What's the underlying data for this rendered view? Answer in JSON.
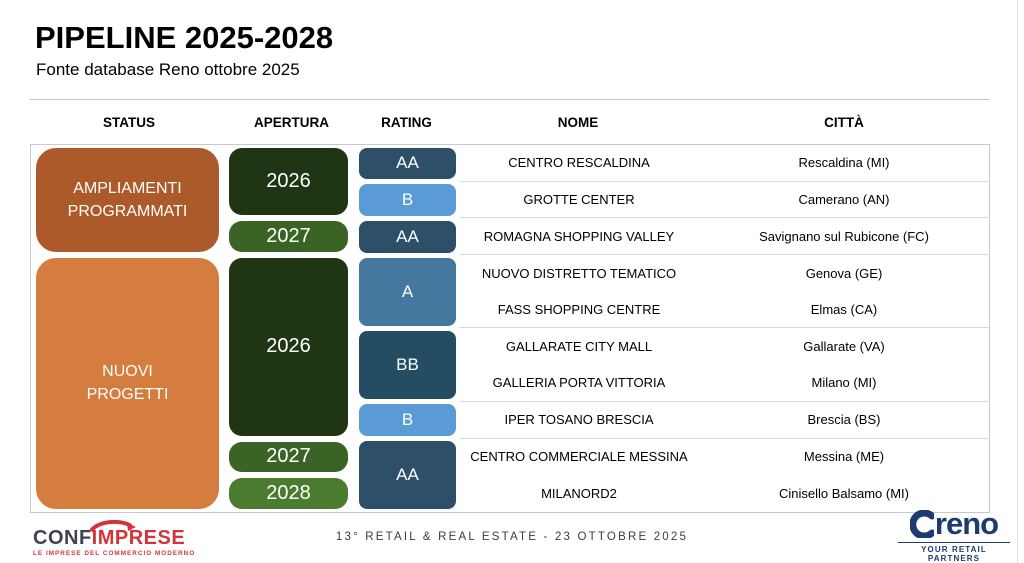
{
  "slide": {
    "title": "PIPELINE 2025-2028",
    "subtitle": "Fonte database Reno ottobre 2025"
  },
  "table": {
    "headers": [
      "STATUS",
      "APERTURA",
      "RATING",
      "NOME",
      "CITTÀ"
    ],
    "status_groups": [
      {
        "label": "AMPLIAMENTI\nPROGRAMMATI",
        "rows": 3,
        "color": "#ad5a2b"
      },
      {
        "label": "NUOVI\nPROGETTI",
        "rows": 7,
        "color": "#d47d3e"
      }
    ],
    "apertura_blocks": [
      {
        "label": "2026",
        "rows": 2,
        "color": "#1f3513"
      },
      {
        "label": "2027",
        "rows": 1,
        "color": "#3a6325"
      },
      {
        "label": "2026",
        "rows": 5,
        "color": "#1f3513"
      },
      {
        "label": "2027",
        "rows": 1,
        "color": "#3a6325"
      },
      {
        "label": "2028",
        "rows": 1,
        "color": "#4a7b2e"
      }
    ],
    "rating_blocks": [
      {
        "label": "AA",
        "rows": 1,
        "color": "#2d5068"
      },
      {
        "label": "B",
        "rows": 1,
        "color": "#5b9bd5"
      },
      {
        "label": "AA",
        "rows": 1,
        "color": "#2d5068"
      },
      {
        "label": "A",
        "rows": 2,
        "color": "#44789f"
      },
      {
        "label": "BB",
        "rows": 2,
        "color": "#244d64"
      },
      {
        "label": "B",
        "rows": 1,
        "color": "#5b9bd5"
      },
      {
        "label": "AA",
        "rows": 2,
        "color": "#2d5068"
      }
    ],
    "rows": [
      {
        "nome": "CENTRO RESCALDINA",
        "citta": "Rescaldina (MI)"
      },
      {
        "nome": "GROTTE CENTER",
        "citta": "Camerano (AN)"
      },
      {
        "nome": "ROMAGNA SHOPPING VALLEY",
        "citta": "Savignano sul Rubicone (FC)"
      },
      {
        "nome": "NUOVO DISTRETTO TEMATICO",
        "citta": "Genova (GE)"
      },
      {
        "nome": "FASS SHOPPING CENTRE",
        "citta": "Elmas (CA)"
      },
      {
        "nome": "GALLARATE CITY MALL",
        "citta": "Gallarate (VA)"
      },
      {
        "nome": "GALLERIA PORTA VITTORIA",
        "citta": "Milano (MI)"
      },
      {
        "nome": "IPER TOSANO BRESCIA",
        "citta": "Brescia (BS)"
      },
      {
        "nome": "CENTRO COMMERCIALE MESSINA",
        "citta": "Messina (ME)"
      },
      {
        "nome": "MILANORD2",
        "citta": "Cinisello Balsamo (MI)"
      }
    ]
  },
  "footer": {
    "event_text": "13° RETAIL & REAL ESTATE - 23 OTTOBRE 2025",
    "confimprese": {
      "part1": "CONF",
      "part2": "IMPRESE",
      "tagline": "LE IMPRESE DEL COMMERCIO MODERNO"
    },
    "reno": {
      "name": "reno",
      "tagline": "YOUR RETAIL PARTNERS"
    }
  },
  "colors": {
    "confimprese_red": "#d2343a",
    "confimprese_charcoal": "#3f434e",
    "reno_navy": "#1e3a6e",
    "line": "#c9c9c9",
    "row_separator": "#d9d9d9",
    "footer_text": "#3c3c3c"
  }
}
